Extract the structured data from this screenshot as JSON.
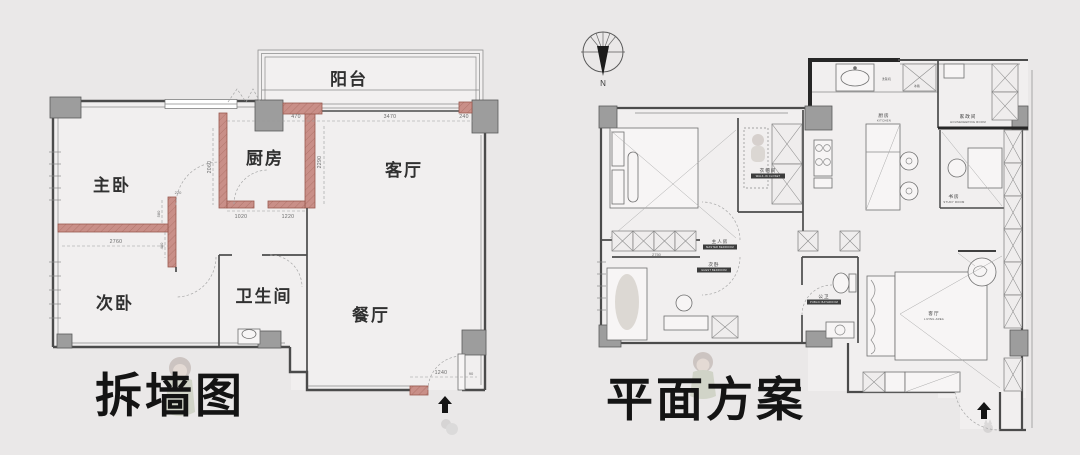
{
  "left_plan": {
    "title": "拆墙图",
    "rooms": {
      "balcony": "阳台",
      "master": "主卧",
      "kitchen": "厨房",
      "living": "客厅",
      "second": "次卧",
      "bathroom": "卫生间",
      "dining": "餐厅"
    },
    "dims": {
      "d470": "470",
      "d3470": "3470",
      "d240": "240",
      "d2060": "2060",
      "d2290": "2290",
      "d220": "220",
      "d580": "580",
      "d480": "480",
      "d2760": "2760",
      "d1020": "1020",
      "d1220": "1220",
      "d1240": "1240",
      "d90": "90"
    }
  },
  "right_plan": {
    "title": "平面方案",
    "compass": "N",
    "rooms": {
      "master_cn": "主人房",
      "master_en": "MASTER BEDROOM",
      "closet_cn": "衣帽间",
      "closet_en": "WALK-IN CLOSET",
      "kitchen_cn": "厨房",
      "kitchen_en": "KITCHEN",
      "housekeeping_cn": "家政间",
      "housekeeping_en": "HOUSEKEEPING ROOM",
      "study_cn": "书房",
      "study_en": "STUDY ROOM",
      "guest_cn": "次卧",
      "guest_en": "GUEST BEDROOM",
      "bathroom_cn": "公卫",
      "bathroom_en": "PUBLIC BATHROOM",
      "living_cn": "客厅",
      "living_en": "LIVING AREA"
    },
    "labels": {
      "dishwasher": "洗碗机",
      "fridge": "冰箱",
      "dim2750": "2750"
    }
  },
  "colors": {
    "background": "#eae8e8",
    "wall": "#4b4b4b",
    "demolish_pink": "#c98f88",
    "column_gray": "#9d9d9d",
    "title_ink": "#141414"
  }
}
